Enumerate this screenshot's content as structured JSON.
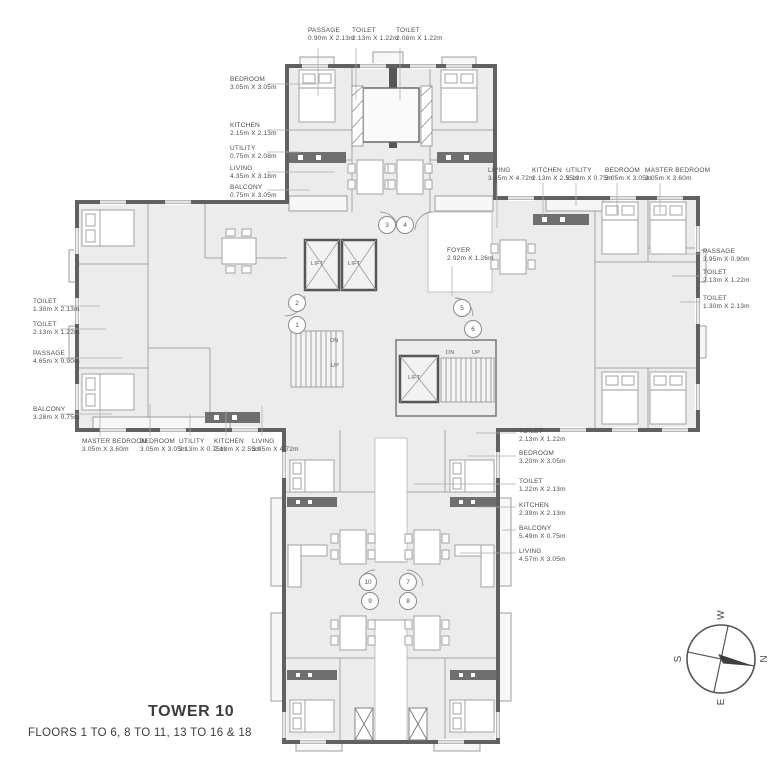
{
  "title": {
    "tower": "TOWER 10",
    "floors": "FLOORS 1 TO 6, 8 TO 11, 13 TO 16 & 18"
  },
  "compass": {
    "n": "N",
    "e": "E",
    "s": "S",
    "w": "W"
  },
  "core": {
    "lift": "LIFT",
    "up": "UP",
    "dn": "DN"
  },
  "units": [
    "1",
    "2",
    "3",
    "4",
    "5",
    "6",
    "7",
    "8",
    "9",
    "10"
  ],
  "rooms": [
    {
      "name": "PASSAGE",
      "dims": "0.90m X 2.13m"
    },
    {
      "name": "TOILET",
      "dims": "2.13m X 1.22m"
    },
    {
      "name": "TOILET",
      "dims": "2.08m X 1.22m"
    },
    {
      "name": "BEDROOM",
      "dims": "3.05m X 3.05m"
    },
    {
      "name": "KITCHEN",
      "dims": "2.15m X 2.13m"
    },
    {
      "name": "UTILITY",
      "dims": "0.75m X 2.08m"
    },
    {
      "name": "LIVING",
      "dims": "4.35m X 3.18m"
    },
    {
      "name": "BALCONY",
      "dims": "0.75m X 3.05m"
    },
    {
      "name": "LIVING",
      "dims": "3.05m X 4.72m"
    },
    {
      "name": "KITCHEN",
      "dims": "2.13m X 2.55m"
    },
    {
      "name": "UTILITY",
      "dims": "2.13m X 0.75m"
    },
    {
      "name": "BEDROOM",
      "dims": "3.05m X 3.05m"
    },
    {
      "name": "MASTER BEDROOM",
      "dims": "3.05m X 3.60m"
    },
    {
      "name": "PASSAGE",
      "dims": "3.95m X 0.90m"
    },
    {
      "name": "TOILET",
      "dims": "2.13m X 1.22m"
    },
    {
      "name": "TOILET",
      "dims": "1.30m X 2.13m"
    },
    {
      "name": "TOILET",
      "dims": "1.30m X 2.13m"
    },
    {
      "name": "TOILET",
      "dims": "2.13m X 1.22m"
    },
    {
      "name": "PASSAGE",
      "dims": "4.65m X 0.90m"
    },
    {
      "name": "BALCONY",
      "dims": "3.28m X 0.75m"
    },
    {
      "name": "MASTER BEDROOM",
      "dims": "3.05m X 3.60m"
    },
    {
      "name": "BEDROOM",
      "dims": "3.05m X 3.05m"
    },
    {
      "name": "UTILITY",
      "dims": "2.13m X 0.75m"
    },
    {
      "name": "KITCHEN",
      "dims": "2.13m X 2.55m"
    },
    {
      "name": "LIVING",
      "dims": "3.05m X 4.72m"
    },
    {
      "name": "FOYER",
      "dims": "2.92m X 1.26m"
    },
    {
      "name": "TOILET",
      "dims": "2.13m X 1.22m"
    },
    {
      "name": "BEDROOM",
      "dims": "3.20m X 3.05m"
    },
    {
      "name": "TOILET",
      "dims": "1.22m X 2.13m"
    },
    {
      "name": "KITCHEN",
      "dims": "2.39m X 2.13m"
    },
    {
      "name": "BALCONY",
      "dims": "5.49m X 0.75m"
    },
    {
      "name": "LIVING",
      "dims": "4.57m X 3.05m"
    }
  ]
}
